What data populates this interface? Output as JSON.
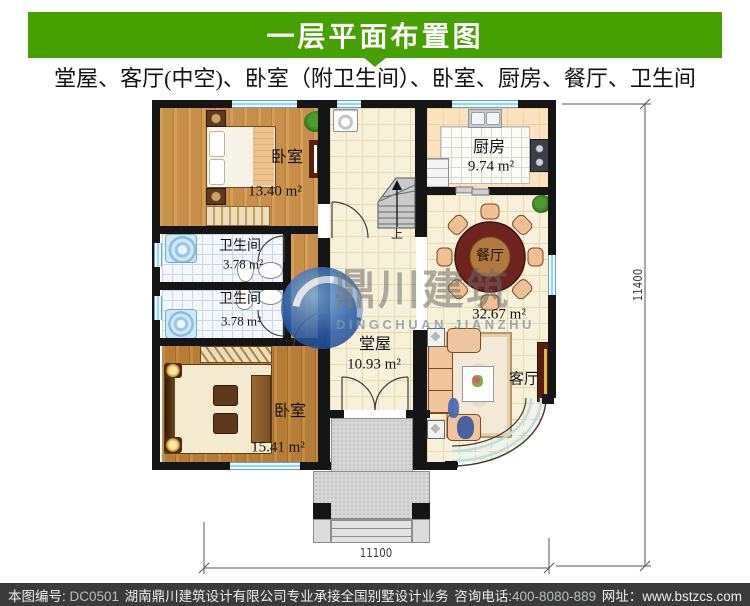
{
  "header": {
    "title": "一层平面布置图",
    "subtitle": "堂屋、客厅(中空)、卧室（附卫生间）、卧室、厨房、餐厅、卫生间"
  },
  "plan": {
    "rooms": {
      "bedroom1": {
        "name": "卧室",
        "area": "13.40 m²"
      },
      "bedroom2": {
        "name": "卧室",
        "area": "15.41 m²"
      },
      "bath1": {
        "name": "卫生间",
        "area": "3.78 m²"
      },
      "bath2": {
        "name": "卫生间",
        "area": "3.78 m²"
      },
      "kitchen": {
        "name": "厨房",
        "area": "9.74 m²"
      },
      "dining": {
        "name": "餐厅",
        "area": "32.67 m²"
      },
      "hall": {
        "name": "堂屋",
        "area": "10.93 m²"
      },
      "living": {
        "name": "客厅"
      }
    },
    "stairs_label": "上",
    "dim_bottom": "11100",
    "dim_right": "11400"
  },
  "watermark": {
    "logo_cn": "鼎川建筑",
    "logo_en": "DINGCHUAN JIANZHU"
  },
  "footer": {
    "sn_label": "本图编号: ",
    "sn": "DC0501",
    "company": "湖南鼎川建筑设计有限公司专业承接全国别墅设计业务",
    "phone_label": "咨询电话:",
    "phone": "400-8080-889",
    "site_label": "网址：",
    "site": "www.bstzcs.com"
  },
  "colors": {
    "accent_green": "#45A000",
    "footer_bg": "#3B3B3B"
  }
}
